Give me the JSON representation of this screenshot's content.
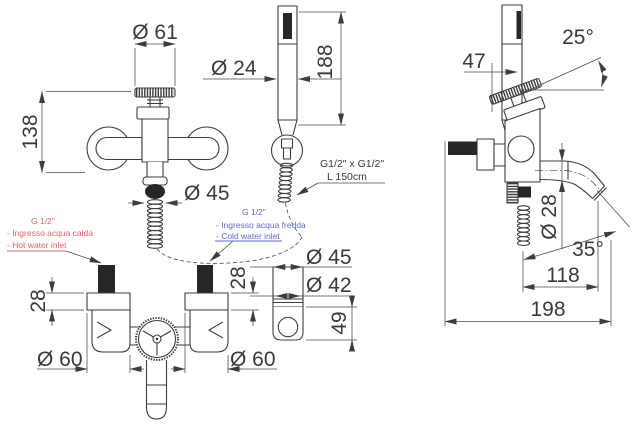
{
  "colors": {
    "line": "#3d3d3d",
    "hot": "#e06565",
    "cold": "#6565d6"
  },
  "front_view": {
    "handle_diameter": "Ø 61",
    "height": "138",
    "outlet_diameter": "Ø 45"
  },
  "hand_shower": {
    "head_diameter": "Ø 24",
    "length": "188",
    "hose_spec_line1": "G1/2\" x G1/2\"",
    "hose_spec_line2": "L 150cm"
  },
  "hot_inlet_note": {
    "thread": "G 1/2\"",
    "italian": "- Ingresso acqua calda",
    "english": "- Hot water inlet"
  },
  "cold_inlet_note": {
    "thread": "G 1/2\"",
    "italian": "- Ingresso acqua fredda",
    "english": "- Cold water inlet"
  },
  "bottom_view": {
    "left_depth": "28",
    "right_depth": "28",
    "left_flange_diameter": "Ø 60",
    "right_flange_diameter": "Ø 60"
  },
  "bracket_view": {
    "outer_diameter": "Ø 45",
    "inner_diameter": "Ø 42",
    "height": "49"
  },
  "side_view": {
    "handle_offset": "47",
    "handle_angle": "25°",
    "spout_diameter": "Ø 28",
    "spout_angle": "35°",
    "spout_reach": "118",
    "total_depth": "198"
  }
}
